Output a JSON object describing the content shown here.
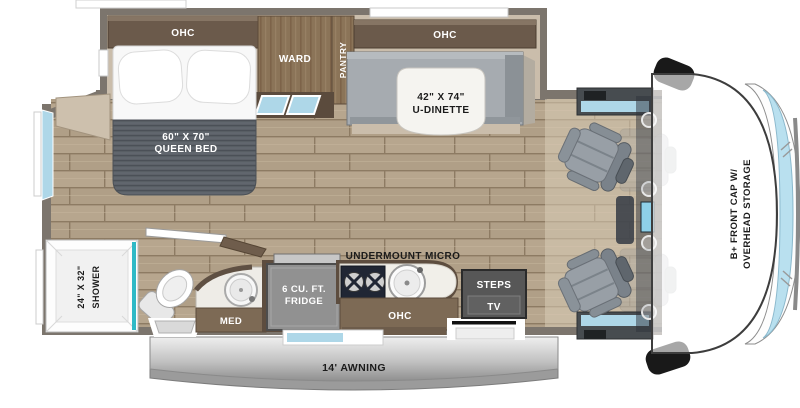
{
  "floorplan": {
    "title": "RV floorplan top view",
    "labels": {
      "bed_ohc": "OHC",
      "ward": "WARD",
      "pantry": "PANTRY",
      "dinette_ohc": "OHC",
      "dinette_line1": "42\" X 74\"",
      "dinette_line2": "U-DINETTE",
      "bed_line1": "60\" X 70\"",
      "bed_line2": "QUEEN BED",
      "front_cap_line1": "B+ FRONT CAP W/",
      "front_cap_line2": "OVERHEAD STORAGE",
      "shower_line1": "24\" X 32\"",
      "shower_line2": "SHOWER",
      "med": "MED",
      "fridge_line1": "6 CU. FT.",
      "fridge_line2": "FRIDGE",
      "undermount_micro": "UNDERMOUNT MICRO",
      "kitchen_ohc": "OHC",
      "steps": "STEPS",
      "tv": "TV",
      "awning": "14' AWNING"
    },
    "palette": {
      "wall": "#7c756d",
      "floor_plank": "#b7a68e",
      "cabinet_dark_brown": "#6b5a4b",
      "cabinet_wood": "#8b7458",
      "blanket_gray": "#5c6168",
      "dinette_gray": "#a6abb0",
      "window_blue": "#aed7e8",
      "shower_teal": "#2fb9c6",
      "windshield_blue": "#b9e0ef",
      "steps_tv_gray": "#575757",
      "awning_silver": "#b9b9b9"
    }
  }
}
